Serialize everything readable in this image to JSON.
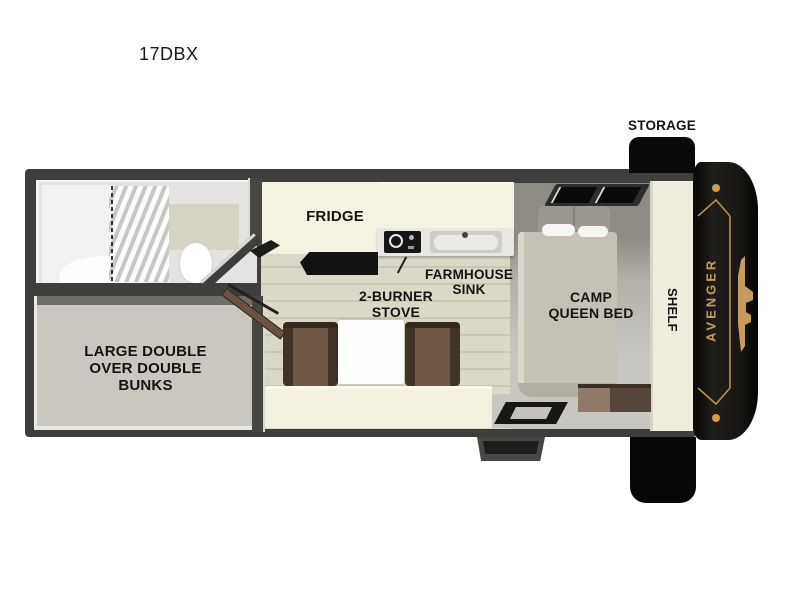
{
  "title": "17DBX",
  "brand": {
    "name": "AVENGER",
    "accent_gold": "#c59c5e",
    "cap_color": "#171614"
  },
  "labels": {
    "storage": "STORAGE",
    "fridge": "FRIDGE",
    "farmhouse_sink": "FARMHOUSE\nSINK",
    "two_burner_stove": "2-BURNER\nSTOVE",
    "camp_queen_bed": "CAMP\nQUEEN BED",
    "shelf": "SHELF",
    "bunks": "LARGE DOUBLE\nOVER DOUBLE\nBUNKS"
  },
  "colors": {
    "wall": "#3e3e3c",
    "counter_cream": "#f6f2e2",
    "wood_floor": "#d9d5c4",
    "bench_brown": "#5e4a39",
    "bunk_floor": "#cac7c0",
    "label_text": "#141414",
    "storage_black": "#0a0a0a"
  }
}
